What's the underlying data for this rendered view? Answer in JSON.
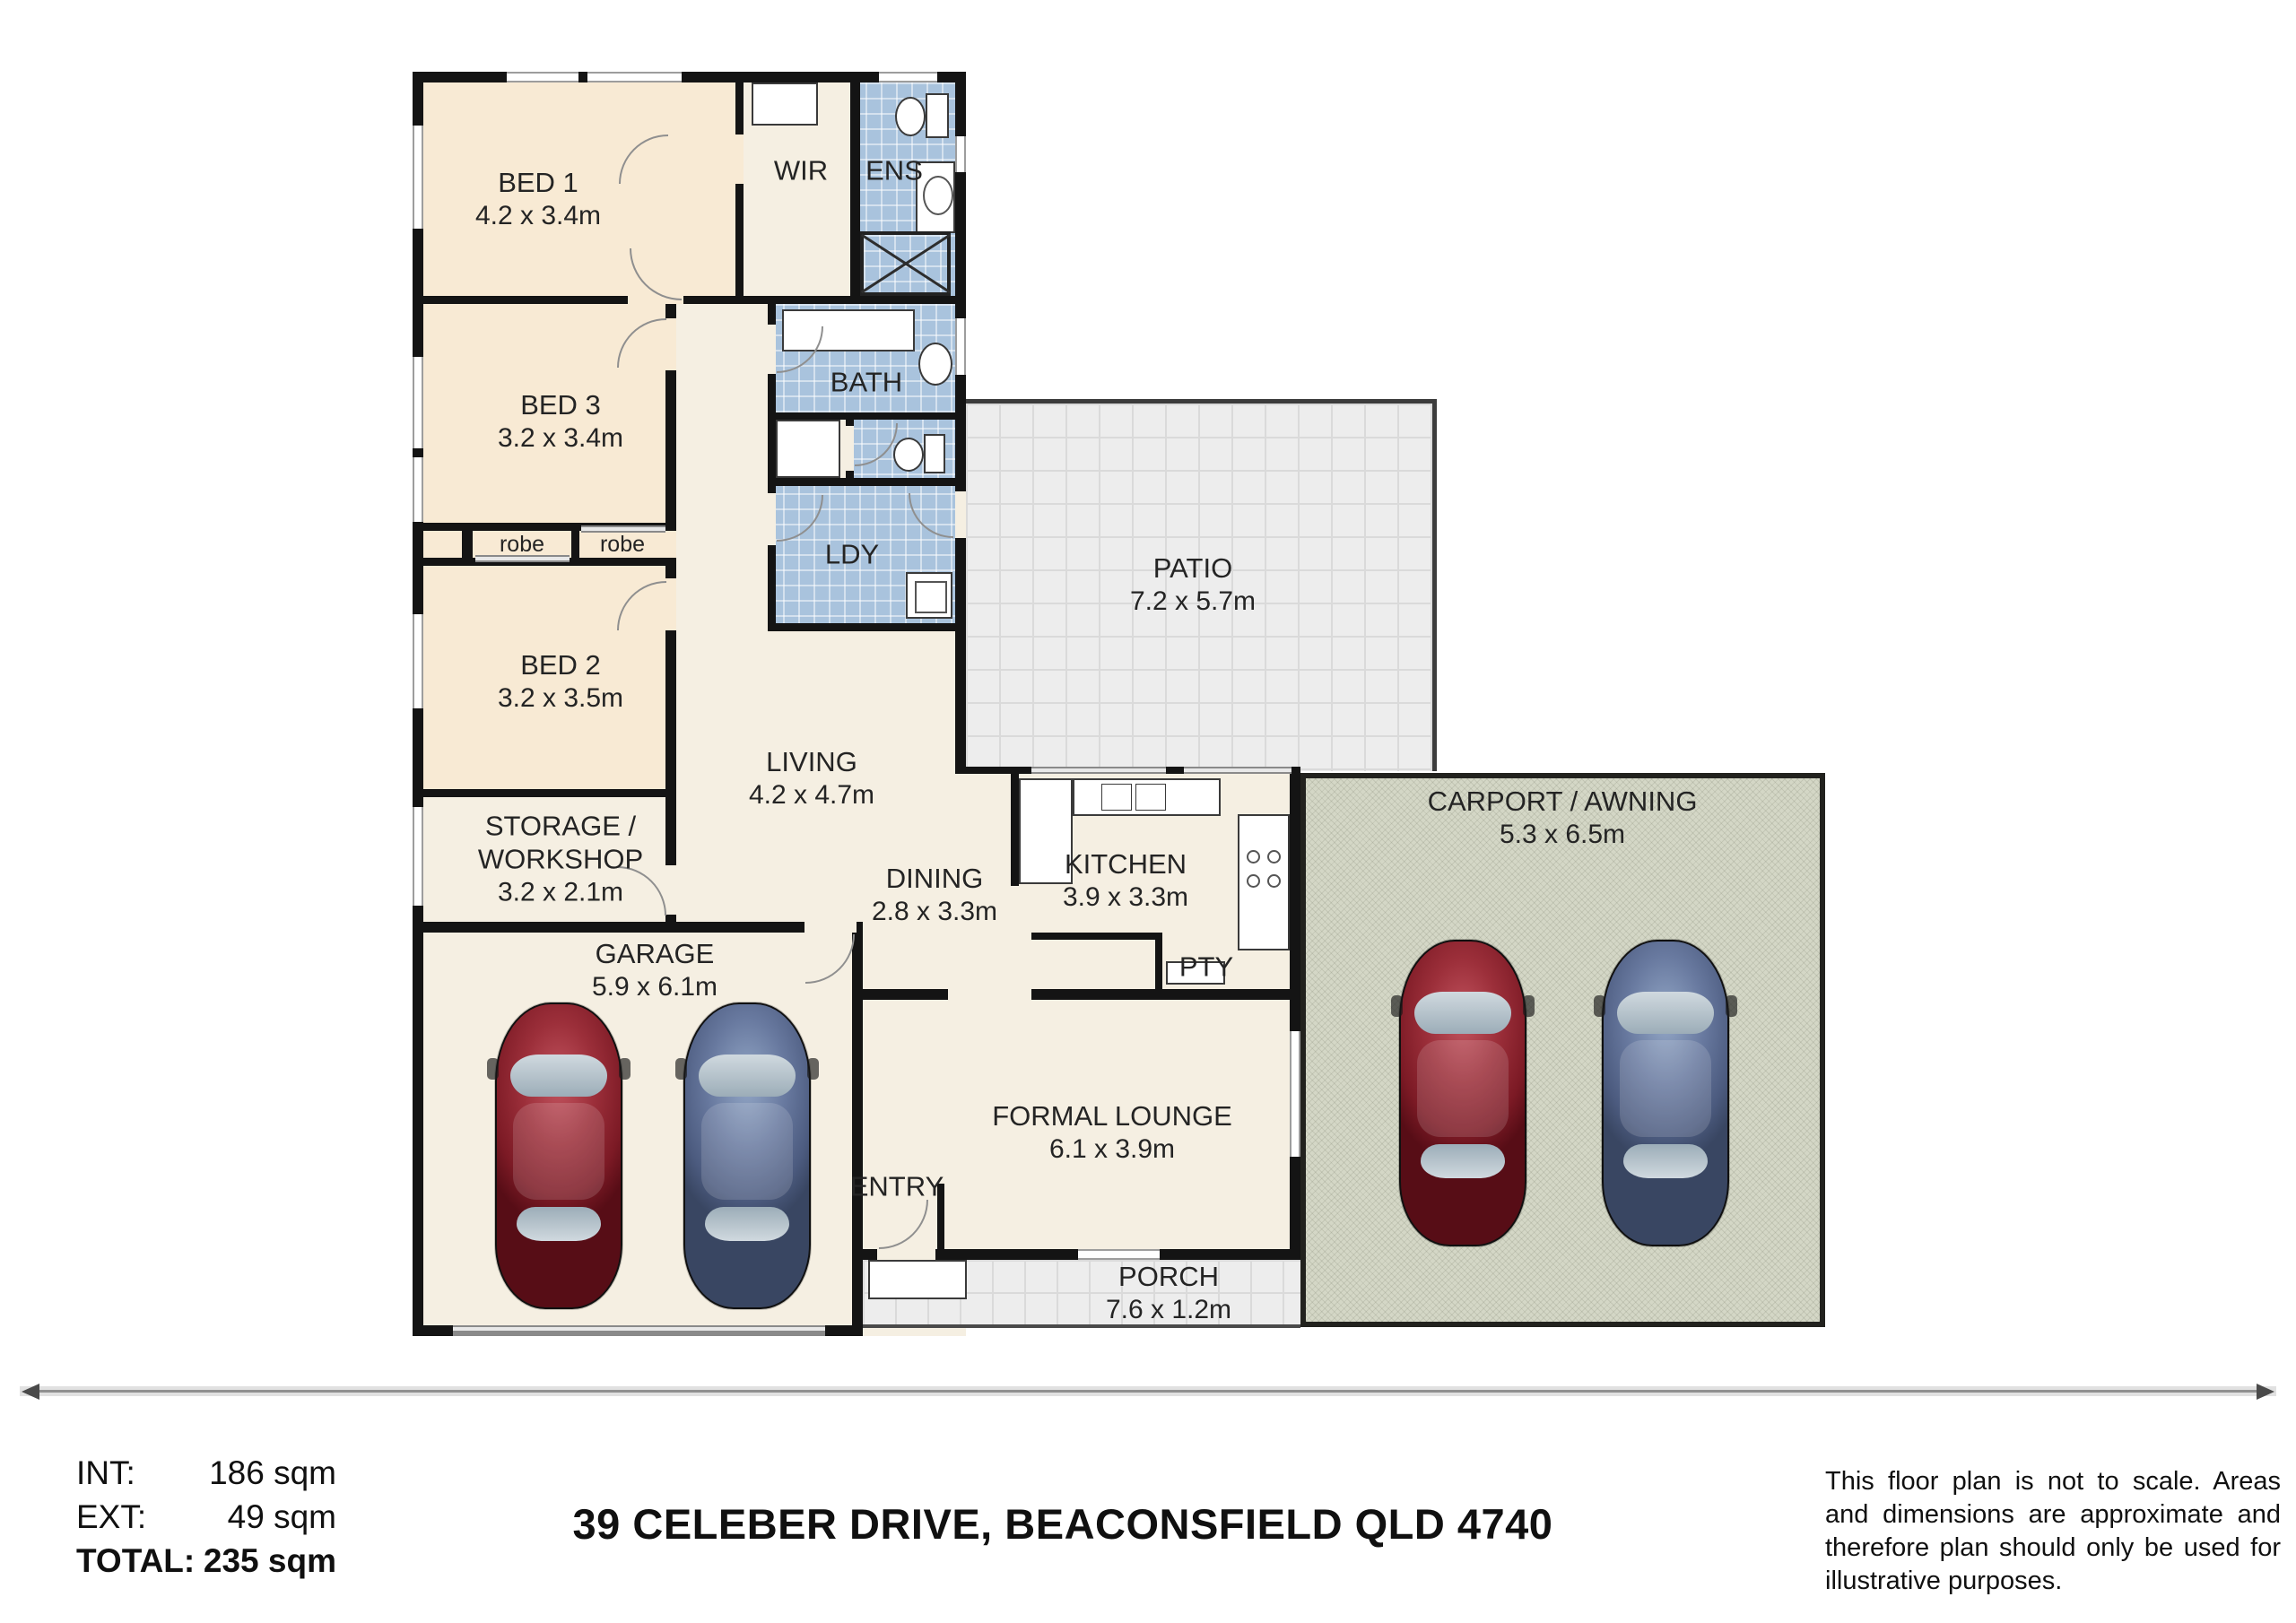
{
  "plan": {
    "rooms": [
      {
        "name": "BED 1",
        "dims": "4.2 x 3.4m"
      },
      {
        "name": "WIR",
        "dims": ""
      },
      {
        "name": "ENS",
        "dims": ""
      },
      {
        "name": "BED 3",
        "dims": "3.2 x 3.4m"
      },
      {
        "name": "BATH",
        "dims": ""
      },
      {
        "name": "robe",
        "dims": ""
      },
      {
        "name": "robe",
        "dims": ""
      },
      {
        "name": "LDY",
        "dims": ""
      },
      {
        "name": "BED 2",
        "dims": "3.2 x 3.5m"
      },
      {
        "name": "PATIO",
        "dims": "7.2 x 5.7m"
      },
      {
        "name": "LIVING",
        "dims": "4.2 x 4.7m"
      },
      {
        "name": "STORAGE / WORKSHOP",
        "dims": "3.2 x 2.1m"
      },
      {
        "name": "DINING",
        "dims": "2.8 x 3.3m"
      },
      {
        "name": "KITCHEN",
        "dims": "3.9 x 3.3m"
      },
      {
        "name": "PTY",
        "dims": ""
      },
      {
        "name": "GARAGE",
        "dims": "5.9 x 6.1m"
      },
      {
        "name": "CARPORT / AWNING",
        "dims": "5.3 x 6.5m"
      },
      {
        "name": "FORMAL LOUNGE",
        "dims": "6.1 x 3.9m"
      },
      {
        "name": "ENTRY",
        "dims": ""
      },
      {
        "name": "PORCH",
        "dims": "7.6 x 1.2m"
      }
    ]
  },
  "summary": {
    "rows": [
      {
        "label": "INT:",
        "value": "186 sqm"
      },
      {
        "label": "EXT:",
        "value": "49 sqm"
      },
      {
        "label": "TOTAL:",
        "value": "235 sqm"
      }
    ]
  },
  "address": "39 CELEBER DRIVE, BEACONSFIELD QLD 4740",
  "disclaimer": "This floor plan is not to scale. Areas and dimensions are approximate and therefore plan should only be used for illustrative purposes."
}
